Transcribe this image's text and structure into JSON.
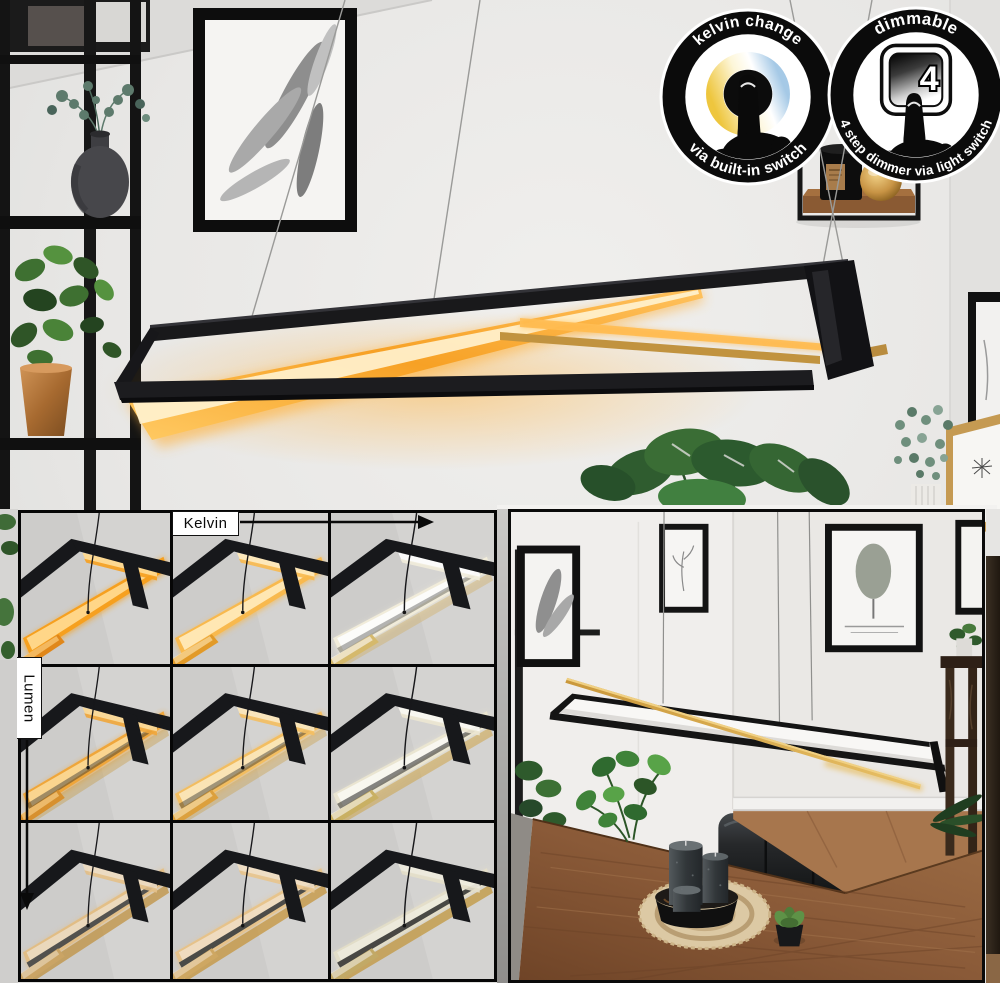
{
  "hero": {
    "badge_kelvin": {
      "top": "kelvin change",
      "bottom": "via built-in switch"
    },
    "badge_dimmable": {
      "top": "dimmable",
      "bottom": "4 step dimmer via light switch",
      "switch_number": "4"
    }
  },
  "grid": {
    "kelvin_label": "Kelvin",
    "lumen_label": "Lumen",
    "cells": [
      {
        "id": "warm-bright",
        "core": "#ffd98e",
        "band": "#f6a01f",
        "deep": "#e0871a",
        "gold": "#c89b42",
        "dim": 1,
        "goldOp": 0
      },
      {
        "id": "neutral-bright",
        "core": "#ffe9b8",
        "band": "#f8b94e",
        "deep": "#e29a28",
        "gold": "#cda04a",
        "dim": 1,
        "goldOp": 0
      },
      {
        "id": "cool-bright",
        "core": "#ffffff",
        "band": "#f3eedb",
        "deep": "#d6b968",
        "gold": "#d2a748",
        "dim": 0.95,
        "goldOp": 0.35
      },
      {
        "id": "warm-mid",
        "core": "#ffd98e",
        "band": "#f3a22b",
        "deep": "#d98a1e",
        "gold": "#c89b42",
        "dim": 0.9,
        "goldOp": 0.45
      },
      {
        "id": "neutral-mid",
        "core": "#ffe9b8",
        "band": "#f7bc55",
        "deep": "#de9c2e",
        "gold": "#cda04a",
        "dim": 0.9,
        "goldOp": 0.45
      },
      {
        "id": "cool-mid",
        "core": "#fffef7",
        "band": "#efe9d2",
        "deep": "#c9ad55",
        "gold": "#cfa445",
        "dim": 0.88,
        "goldOp": 0.6
      },
      {
        "id": "warm-low",
        "core": "#f7debc",
        "band": "#eab86b",
        "deep": "#c9963f",
        "gold": "#c0903c",
        "dim": 0.72,
        "goldOp": 1
      },
      {
        "id": "neutral-low",
        "core": "#fae3c0",
        "band": "#eec077",
        "deep": "#cf9c42",
        "gold": "#c6963e",
        "dim": 0.76,
        "goldOp": 1
      },
      {
        "id": "cool-low",
        "core": "#f6f2e2",
        "band": "#e9e2c8",
        "deep": "#bfa04b",
        "gold": "#c39a44",
        "dim": 0.78,
        "goldOp": 1
      }
    ]
  },
  "colors": {
    "lamp_glow_warm": "#f6a01f",
    "lamp_gold": "#c1933f",
    "frame_black": "#17181b",
    "photo_border": "#0a0a0a"
  }
}
